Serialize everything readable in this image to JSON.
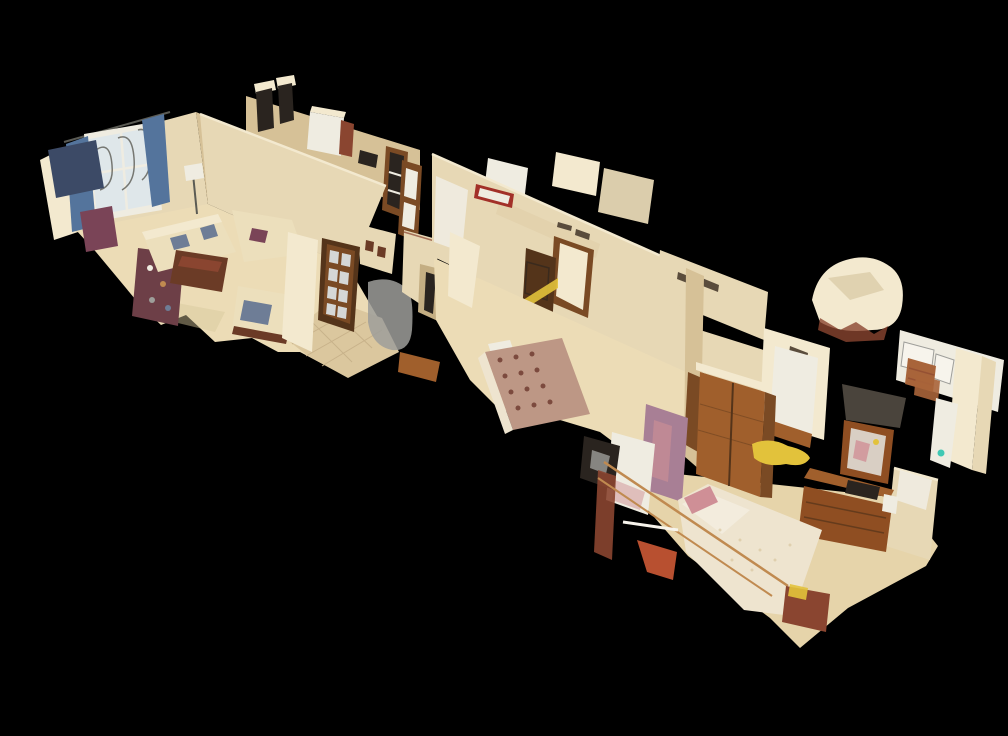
{
  "scene": {
    "title": "3D dollhouse cutaway view of a furnished apartment",
    "view_mode": "dollhouse",
    "rooms": [
      {
        "id": "living-room",
        "label": "Living room with window, blue curtains, cream sofas, coffee table and cluttered shelving"
      },
      {
        "id": "kitchen",
        "label": "Kitchen with chimney pillars, white island and tall wooden cabinets"
      },
      {
        "id": "hallway",
        "label": "Hallway with glazed dark-wood double door, tiled floor and gray scan artifact"
      },
      {
        "id": "bedroom-1",
        "label": "Bedroom with floral bedspread and open wooden door with yellow banner"
      },
      {
        "id": "inner-hall",
        "label": "Inner hall with bright doorway and wall vents"
      },
      {
        "id": "bedroom-2",
        "label": "Master bedroom with brass bed, sliding wooden wardrobe, framed mirror and dresser"
      },
      {
        "id": "bathroom",
        "label": "Bathroom with white fixtures and copper towels"
      }
    ]
  },
  "colors": {
    "bg": "#000000",
    "wallCream": "#e7d8b5",
    "wallCreamLight": "#f3e9cf",
    "wallCreamDark": "#d6c197",
    "wallShade": "#c4ae83",
    "wallWhite": "#efece1",
    "fixtureWhite": "#f7f4ec",
    "floorLiving": "#ecdcb6",
    "floorTile": "#dbc79e",
    "floorBed2": "#e6d4aa",
    "grout": "#c8b28a",
    "woodDoorDark": "#54341a",
    "woodDoorMid": "#7a4a24",
    "woodWarm": "#a05f2c",
    "woodRed": "#8a4530",
    "tableWood": "#6b3b26",
    "dresserWood": "#8f4e22",
    "sofaCream": "#ecdfbc",
    "sofaShadow": "#d8c79b",
    "cushionBlue": "#6e7d96",
    "chairNavy": "#3c4a66",
    "chairMaroon": "#7a4457",
    "shelfMaroon": "#6d3f47",
    "orangeChair": "#b85030",
    "curtainBlue": "#54749c",
    "glassLight": "#dfe7ea",
    "ironGrey": "#5b5b54",
    "bedFloral": "#bd9785",
    "bedFloralDot": "#7c4a3e",
    "bedLace": "#eee4cf",
    "pillowPink": "#cf8f96",
    "mauve": "#a87f95",
    "yellowAccent": "#e2c23b",
    "grayArtifact": "#9e9e9a",
    "darkObject": "#2a241f",
    "slabDark": "#4a443c",
    "ventDark": "#5a4c3c",
    "brass": "#c08a50",
    "towelCopper": "#a8643a",
    "redAccent": "#a23028",
    "tealAccent": "#3fc8b4",
    "mirrorGlass": "#d9cfc4"
  }
}
